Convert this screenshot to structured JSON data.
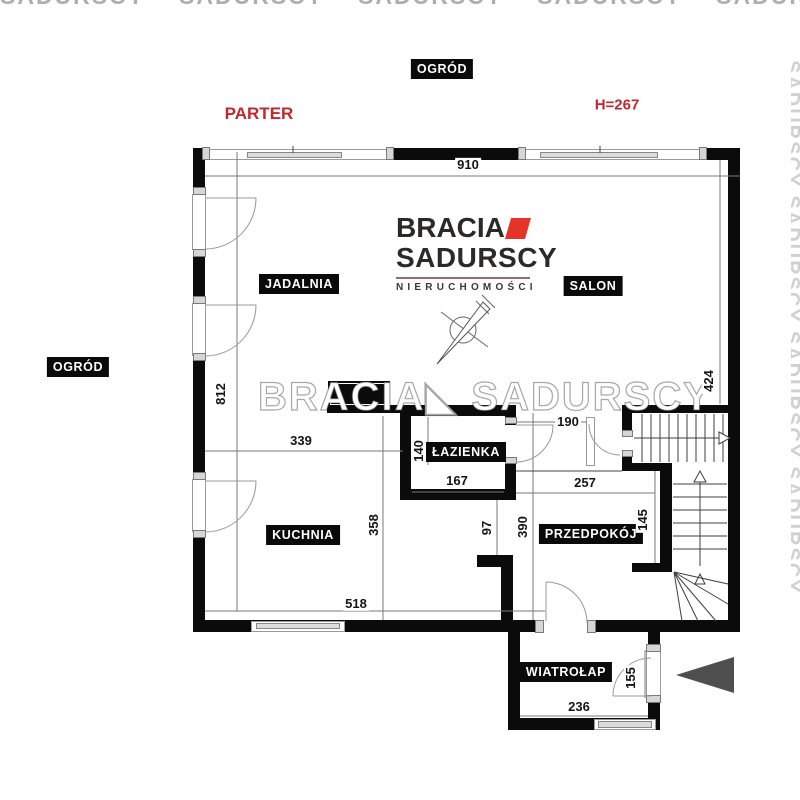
{
  "annotations": {
    "floor": "PARTER",
    "ceiling_height": "H=267",
    "garden_top": "OGRÓD",
    "garden_left": "OGRÓD"
  },
  "rooms": {
    "dining": "JADALNIA",
    "living": "SALON",
    "bathroom": "ŁAZIENKA",
    "kitchen": "KUCHNIA",
    "hallway": "PRZEDPOKÓJ",
    "vestibule": "WIATROŁAP"
  },
  "dimensions": {
    "top_width": "910",
    "right_height": "424",
    "left_height": "812",
    "dining_kitchen_width": "339",
    "bathroom_depth": "140",
    "bathroom_width": "167",
    "passage_width": "190",
    "hall_width": "257",
    "stair_niche": "145",
    "hall_depth": "390",
    "corridor_gap": "97",
    "kitchen_depth": "358",
    "bottom_width": "518",
    "entry_door": "155",
    "vestibule_width": "236"
  },
  "logo": {
    "brand_line1": "BRACIA",
    "brand_line2": "SADURSCY",
    "tagline": "NIERUCHOMOŚCI"
  },
  "watermark": {
    "top": "SADURSCY SADURSCY SADURSCY SADURSCY SADURSCY SADURSCY SADURSCY",
    "center": "BRACIA◣ SADURSCY",
    "right": "SADURSCY SADURSCY SADURSCY SADURSCY"
  },
  "colors": {
    "accent_red": "#c1272d",
    "logo_red": "#e5332a",
    "wall_black": "#0b0b0b",
    "arrow_gray": "#4f4f4f"
  }
}
